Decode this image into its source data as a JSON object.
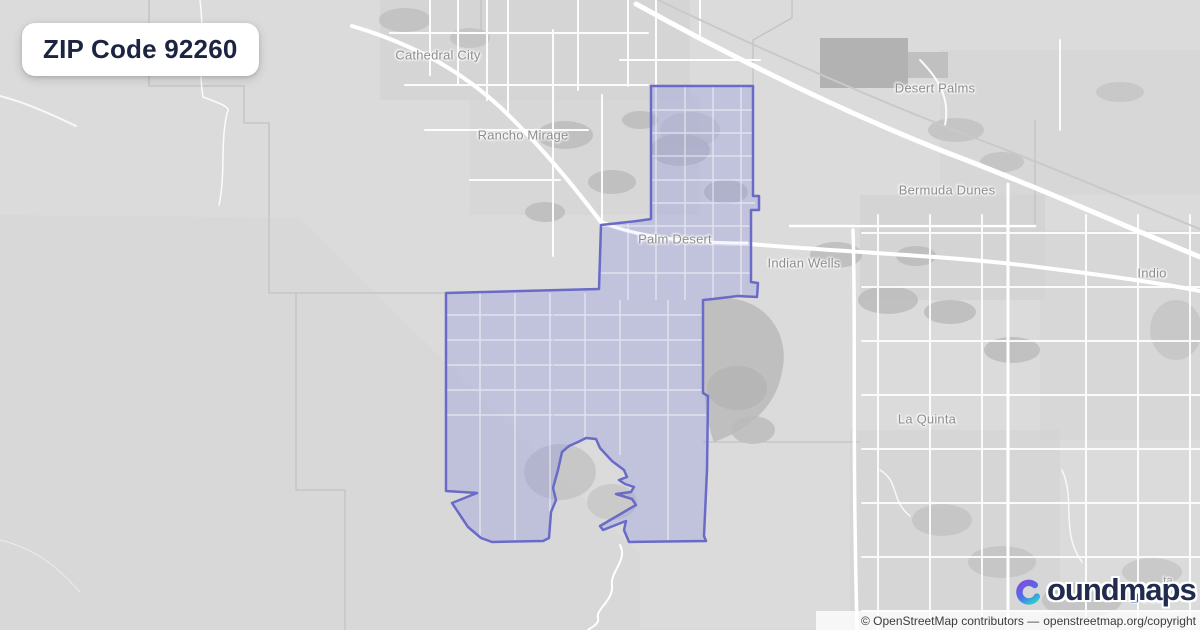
{
  "badge": {
    "text": "ZIP Code 92260"
  },
  "map": {
    "labels": [
      {
        "name": "cathedral-city",
        "text": "Cathedral City"
      },
      {
        "name": "rancho-mirage",
        "text": "Rancho Mirage"
      },
      {
        "name": "desert-palms",
        "text": "Desert Palms"
      },
      {
        "name": "bermuda-dunes",
        "text": "Bermuda Dunes"
      },
      {
        "name": "palm-desert",
        "text": "Palm Desert"
      },
      {
        "name": "indian-wells",
        "text": "Indian Wells"
      },
      {
        "name": "indio",
        "text": "Indio"
      },
      {
        "name": "la-quinta",
        "text": "La Quinta"
      }
    ],
    "label_fragments": [
      {
        "name": "fragment-ta",
        "text": "ta"
      },
      {
        "name": "fragment-usa",
        "text": "USa"
      }
    ],
    "zip": {
      "code": "92260",
      "boundary_color": "#6a6bc7",
      "fill_color": "rgba(150,155,224,0.38)",
      "points": "651,86 753,86 753,196 759,196 759,210 751,210 751,282 758,283 757,297 738,296 713,299 703,300 703,393 708,396 707,470 704,536 706,541 629,542 624,530 626,521 603,530 600,526 629,509 636,505 632,499 616,494 631,492 634,487 625,484 619,480 627,477 624,470 612,461 600,448 596,439 586,438 578,442 569,446 562,452 558,470 553,488 556,500 551,512 549,538 543,541 492,542 481,538 468,527 452,503 477,493 446,491 446,293 599,289 601,225 637,221 651,219"
    }
  },
  "branding": {
    "wordmark": "boundmaps",
    "wordmark_rest": "oundmaps",
    "icon_colors": {
      "purple": "#7b50e0",
      "blue": "#4f6fe6",
      "teal": "#2bc3d6"
    },
    "navy": "#212b4e"
  },
  "attribution": {
    "prefix": "© OpenStreetMap contributors —",
    "link": "openstreetmap.org/copyright"
  }
}
